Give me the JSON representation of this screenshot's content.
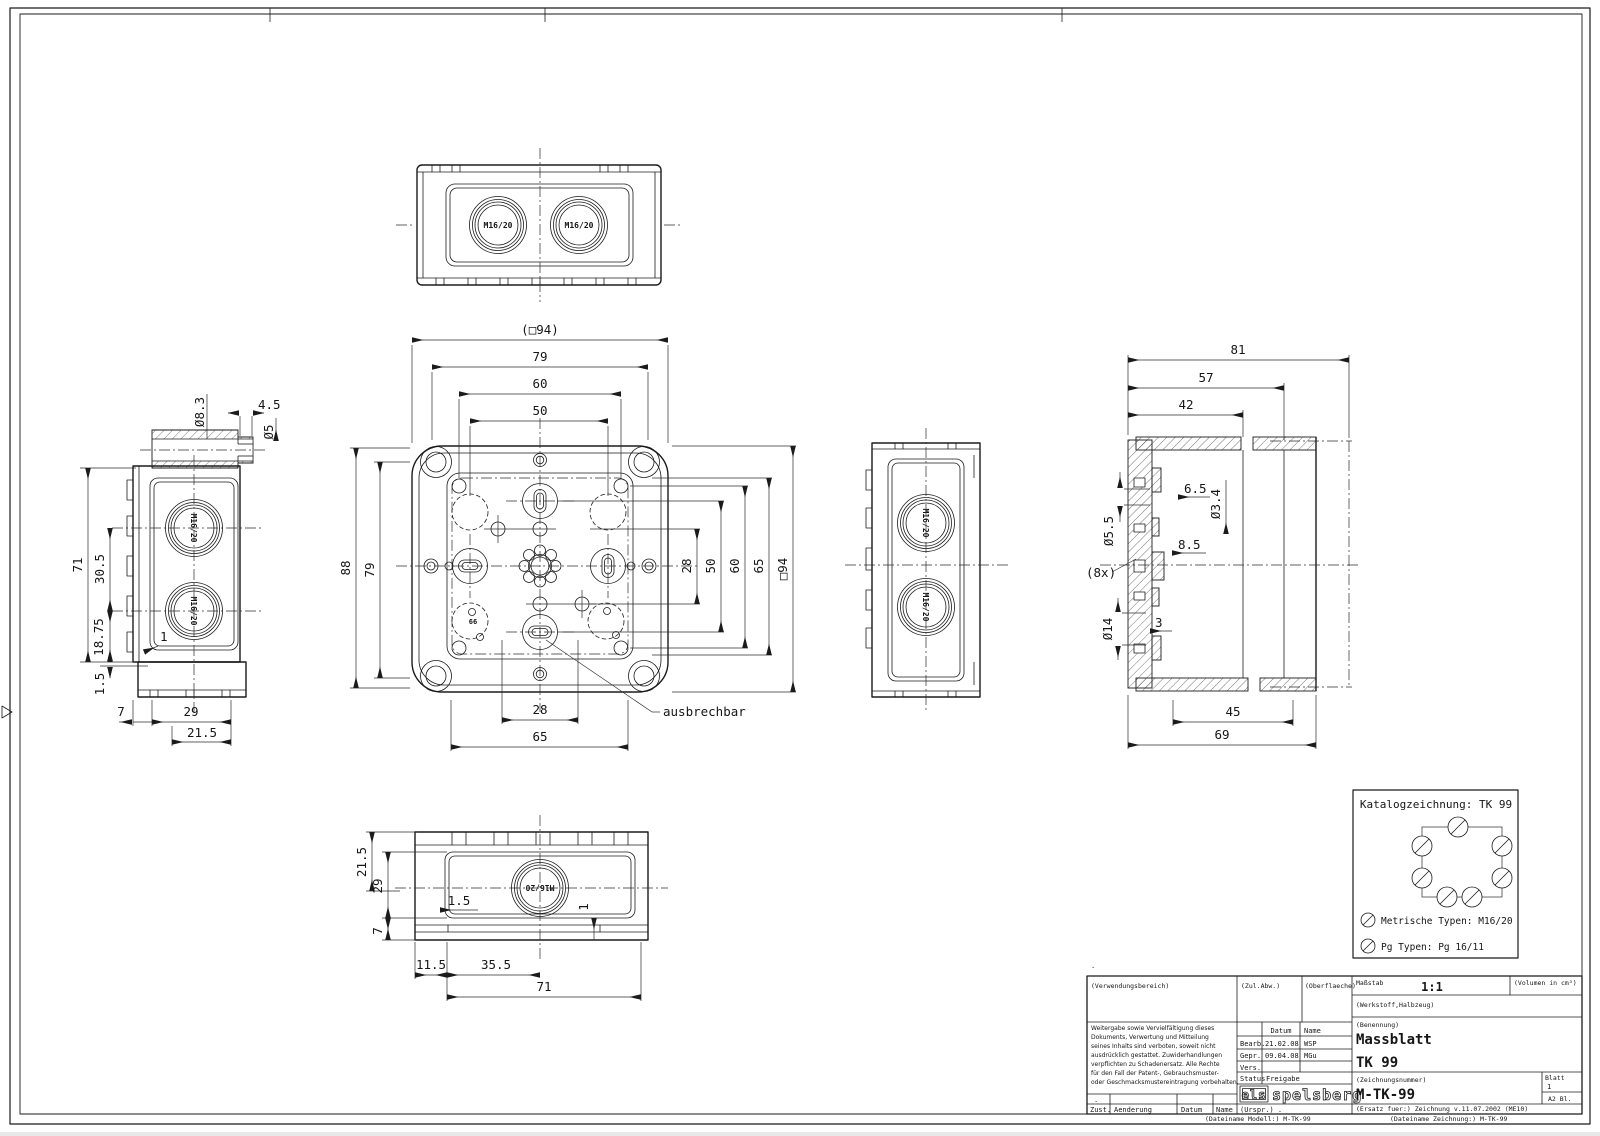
{
  "meta": {
    "document_type": "technical dimension drawing",
    "colors": {
      "line": "#1b1b1b",
      "background": "#ffffff",
      "dimension": "#2c2c2c"
    }
  },
  "views": {
    "top": {
      "knockouts": [
        "M16/20",
        "M16/20"
      ]
    },
    "front": {
      "dims_top": [
        "(□94)",
        "79",
        "60",
        "50"
      ],
      "dims_left": [
        "88",
        "79"
      ],
      "dims_right": [
        "28",
        "50",
        "60",
        "65",
        "□94"
      ],
      "dims_bottom": [
        "28",
        "65"
      ],
      "callout": "ausbrechbar",
      "note": "66"
    },
    "left": {
      "knockouts": [
        "M16/20",
        "M16/20"
      ],
      "dims_top": [
        "Ø8.3",
        "4.5",
        "Ø5"
      ],
      "dims_left": [
        "71",
        "30.5",
        "18.75",
        "1.5",
        "1"
      ],
      "dims_bottom": [
        "7",
        "29",
        "21.5"
      ]
    },
    "right": {
      "knockouts": [
        "M16/20",
        "M16/20"
      ]
    },
    "section": {
      "dims_top": [
        "81",
        "57",
        "42"
      ],
      "dims_left": [
        "6.5",
        "Ø3.4",
        "Ø5.5",
        "8.5",
        "(8x)",
        "Ø14",
        "3"
      ],
      "dims_bottom": [
        "45",
        "69"
      ]
    },
    "bottom": {
      "knockout": "M16/20",
      "dims_left": [
        "21.5",
        "29",
        "7"
      ],
      "dims_inner": [
        "1.5",
        "1"
      ],
      "dims_bottom": [
        "11.5",
        "35.5",
        "71"
      ]
    }
  },
  "catalog": {
    "title": "Katalogzeichnung: TK 99",
    "metric_label": "Metrische Typen: M16/20",
    "pg_label": "Pg Typen: Pg 16/11"
  },
  "title_block": {
    "dot_above": ".",
    "dot_row": ".",
    "verwendungsbereich": "(Verwendungsbereich)",
    "zul_abw": "(Zul.Abw.)",
    "oberflaeche": "(Oberflaeche)",
    "massstab_label": "Maßstab",
    "massstab_value": "1:1",
    "volumen": "(Volumen in cm³)",
    "werkstoff": "(Werkstoff,Halbzeug)",
    "legal_lines": [
      "Weitergabe sowie Vervielfältigung dieses",
      "Dokuments, Verwertung und Mitteilung",
      "seines Inhalts sind verboten, soweit nicht",
      "ausdrücklich gestattet. Zuwiderhandlungen",
      "verpflichten zu Schadenersatz. Alle Rechte",
      "für den Fall der Patent-, Gebrauchsmuster-",
      "oder Geschmacksmustereintragung vorbehalten."
    ],
    "approval": {
      "datum_header": "Datum",
      "name_header": "Name",
      "bearb_label": "Bearb.",
      "bearb_datum": "21.02.08",
      "bearb_name": "WSP",
      "gepr_label": "Gepr.",
      "gepr_datum": "09.04.08",
      "gepr_name": "MGu",
      "vers_label": "Vers.",
      "status_label": "Status",
      "status_value": "Freigabe"
    },
    "logo_els": "els",
    "logo_spelsberg": "spelsberg",
    "benennung_label": "(Benennung)",
    "benennung_value1": "Massblatt",
    "benennung_value2": "TK 99",
    "zeichnungsnummer_label": "(Zeichnungsnummer)",
    "zeichnungsnummer_value": "M-TK-99",
    "blatt_label": "Blatt",
    "blatt_value": "1",
    "blatt_format": "A2  Bl.",
    "ersatz": "(Ersatz fuer:)  Zeichnung v.11.07.2002 (ME10)",
    "zust": "Zust.",
    "aenderung": "Aenderung",
    "datum2": "Datum",
    "name2": "Name",
    "urspr": "(Urspr.) .",
    "dateiname_modell": "(Dateiname Modell:) M-TK-99",
    "dateiname_zeichnung": "(Dateiname Zeichnung:) M-TK-99"
  }
}
